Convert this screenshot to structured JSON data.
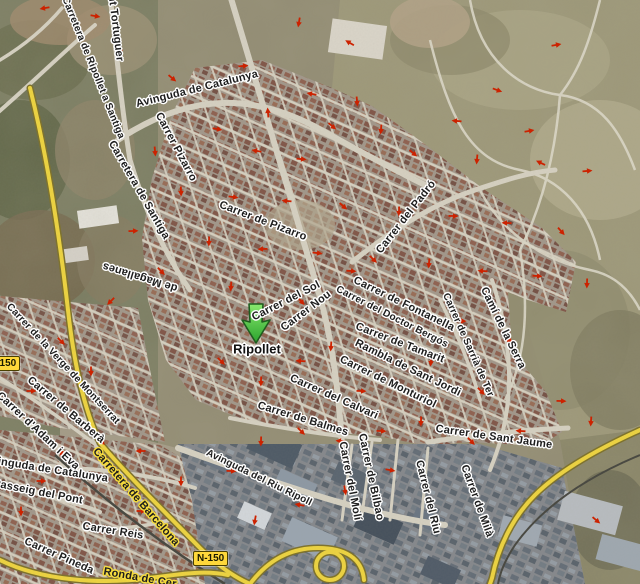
{
  "map": {
    "place_label": "Ripollet",
    "marker": {
      "type": "green-arrow",
      "tip_x": 256,
      "tip_y": 343
    },
    "colors": {
      "marker_green": "#3fc53f",
      "marker_outline": "#1f5c1f",
      "one_way_arrow": "#cc2200",
      "highway_yellow": "#eed43f",
      "label_halo_white": "#ffffff",
      "label_halo_yellow": "#f6dc3e",
      "badge_yellow": "#ffd83a"
    },
    "badges": [
      {
        "text": "N-150",
        "x": -15,
        "y": 356,
        "note": "left edge, partially clipped"
      },
      {
        "text": "N-150",
        "x": 193,
        "y": 551
      }
    ],
    "street_labels": [
      {
        "text": "Torrent Tortuguer",
        "x": 114,
        "y": 14,
        "rot": 83,
        "style": "white"
      },
      {
        "text": "Carretera de Ripollet a Santiga",
        "x": 93,
        "y": 68,
        "rot": 68,
        "style": "white"
      },
      {
        "text": "Avinguda de Catalunya",
        "x": 197,
        "y": 89,
        "rot": -14,
        "style": "white"
      },
      {
        "text": "Carrer Pizarro",
        "x": 176,
        "y": 147,
        "rot": 62,
        "style": "white"
      },
      {
        "text": "Carretera de Santiga",
        "x": 139,
        "y": 190,
        "rot": 60,
        "style": "white"
      },
      {
        "text": "de Magallanes",
        "x": 140,
        "y": 277,
        "rot": 197,
        "style": "white"
      },
      {
        "text": "Carrer de Pizarro",
        "x": 263,
        "y": 221,
        "rot": 21,
        "style": "white"
      },
      {
        "text": "Carrer del Padró",
        "x": 406,
        "y": 217,
        "rot": -52,
        "style": "white"
      },
      {
        "text": "Carrer del Sol",
        "x": 286,
        "y": 301,
        "rot": -27,
        "style": "white"
      },
      {
        "text": "Carrer Nou",
        "x": 306,
        "y": 311,
        "rot": -37,
        "style": "white"
      },
      {
        "text": "Carrer de Fontanella",
        "x": 404,
        "y": 304,
        "rot": 26,
        "style": "white"
      },
      {
        "text": "Carrer del Doctor Bergós",
        "x": 392,
        "y": 317,
        "rot": 27,
        "style": "white"
      },
      {
        "text": "Carrer de Tamarit",
        "x": 400,
        "y": 343,
        "rot": 21,
        "style": "white"
      },
      {
        "text": "Rambla de Sant Jordi",
        "x": 408,
        "y": 368,
        "rot": 26,
        "style": "white"
      },
      {
        "text": "Carrer de Monturiol",
        "x": 388,
        "y": 382,
        "rot": 26,
        "style": "white"
      },
      {
        "text": "Carrer del Calvari",
        "x": 334,
        "y": 397,
        "rot": 24,
        "style": "white"
      },
      {
        "text": "Carrer de Balmes",
        "x": 303,
        "y": 419,
        "rot": 17,
        "style": "white"
      },
      {
        "text": "Camí de la Serra",
        "x": 503,
        "y": 328,
        "rot": 64,
        "style": "white"
      },
      {
        "text": "Carrer de Sarrià de Ter",
        "x": 468,
        "y": 345,
        "rot": 66,
        "style": "white"
      },
      {
        "text": "Carrer de Sant Jaume",
        "x": 494,
        "y": 437,
        "rot": 8,
        "style": "white"
      },
      {
        "text": "Carrer de Milà",
        "x": 477,
        "y": 501,
        "rot": 70,
        "style": "white"
      },
      {
        "text": "Carrer del Riu",
        "x": 428,
        "y": 497,
        "rot": 76,
        "style": "white"
      },
      {
        "text": "Carrer de Bilbao",
        "x": 371,
        "y": 477,
        "rot": 78,
        "style": "white"
      },
      {
        "text": "Carrer del Molí",
        "x": 350,
        "y": 481,
        "rot": 79,
        "style": "white"
      },
      {
        "text": "Avinguda del Riu Ripoll",
        "x": 259,
        "y": 478,
        "rot": 26,
        "style": "white"
      },
      {
        "text": "Carrer de la Verge de Montserrat",
        "x": 63,
        "y": 364,
        "rot": 47,
        "style": "white"
      },
      {
        "text": "Carrer de Barberà",
        "x": 66,
        "y": 410,
        "rot": 40,
        "style": "white"
      },
      {
        "text": "Carrer d'Adam i Eva",
        "x": 38,
        "y": 431,
        "rot": 43,
        "style": "white"
      },
      {
        "text": "Avinguda de Catalunya",
        "x": 46,
        "y": 469,
        "rot": 9,
        "style": "white"
      },
      {
        "text": "Passeig del Pont",
        "x": 38,
        "y": 492,
        "rot": 11,
        "style": "white"
      },
      {
        "text": "Carretera de Barcelona",
        "x": 136,
        "y": 497,
        "rot": 49,
        "style": "yellow"
      },
      {
        "text": "Carrer Reis",
        "x": 113,
        "y": 531,
        "rot": 9,
        "style": "white"
      },
      {
        "text": "Carrer Pineda",
        "x": 59,
        "y": 556,
        "rot": 24,
        "style": "white"
      },
      {
        "text": "Ronda de Cer",
        "x": 140,
        "y": 578,
        "rot": 10,
        "style": "yellow"
      }
    ],
    "one_way_arrows": [
      [
        45,
        8,
        170
      ],
      [
        95,
        16,
        10
      ],
      [
        299,
        22,
        100
      ],
      [
        350,
        43,
        210
      ],
      [
        556,
        45,
        350
      ],
      [
        120,
        50,
        80
      ],
      [
        243,
        66,
        355
      ],
      [
        172,
        78,
        40
      ],
      [
        312,
        94,
        190
      ],
      [
        357,
        101,
        85
      ],
      [
        497,
        90,
        20
      ],
      [
        268,
        113,
        265
      ],
      [
        217,
        129,
        10
      ],
      [
        332,
        126,
        40
      ],
      [
        381,
        129,
        95
      ],
      [
        457,
        121,
        185
      ],
      [
        529,
        131,
        350
      ],
      [
        155,
        151,
        85
      ],
      [
        257,
        151,
        190
      ],
      [
        301,
        159,
        5
      ],
      [
        413,
        153,
        40
      ],
      [
        477,
        159,
        95
      ],
      [
        541,
        163,
        205
      ],
      [
        587,
        171,
        355
      ],
      [
        181,
        191,
        88
      ],
      [
        233,
        197,
        8
      ],
      [
        287,
        201,
        185
      ],
      [
        343,
        206,
        42
      ],
      [
        399,
        211,
        92
      ],
      [
        453,
        216,
        2
      ],
      [
        507,
        223,
        182
      ],
      [
        561,
        231,
        48
      ],
      [
        133,
        231,
        358
      ],
      [
        209,
        241,
        92
      ],
      [
        263,
        249,
        178
      ],
      [
        317,
        253,
        6
      ],
      [
        373,
        259,
        44
      ],
      [
        429,
        263,
        94
      ],
      [
        483,
        271,
        184
      ],
      [
        537,
        276,
        4
      ],
      [
        587,
        283,
        92
      ],
      [
        161,
        271,
        46
      ],
      [
        231,
        286,
        94
      ],
      [
        351,
        271,
        4
      ],
      [
        301,
        301,
        48
      ],
      [
        331,
        346,
        94
      ],
      [
        361,
        391,
        2
      ],
      [
        301,
        361,
        184
      ],
      [
        261,
        381,
        92
      ],
      [
        221,
        361,
        44
      ],
      [
        421,
        331,
        94
      ],
      [
        461,
        321,
        2
      ],
      [
        511,
        341,
        184
      ],
      [
        481,
        391,
        46
      ],
      [
        431,
        361,
        94
      ],
      [
        561,
        401,
        2
      ],
      [
        591,
        421,
        94
      ],
      [
        521,
        431,
        184
      ],
      [
        471,
        441,
        46
      ],
      [
        421,
        421,
        92
      ],
      [
        381,
        431,
        2
      ],
      [
        341,
        441,
        184
      ],
      [
        301,
        431,
        44
      ],
      [
        261,
        441,
        92
      ],
      [
        231,
        471,
        2
      ],
      [
        181,
        481,
        90
      ],
      [
        141,
        451,
        180
      ],
      [
        101,
        441,
        45
      ],
      [
        61,
        451,
        90
      ],
      [
        41,
        481,
        0
      ],
      [
        21,
        511,
        90
      ],
      [
        141,
        511,
        0
      ],
      [
        61,
        341,
        45
      ],
      [
        91,
        371,
        90
      ],
      [
        31,
        391,
        0
      ],
      [
        111,
        301,
        135
      ],
      [
        596,
        520,
        40
      ],
      [
        345,
        490,
        80
      ],
      [
        390,
        470,
        10
      ],
      [
        255,
        520,
        100
      ],
      [
        300,
        505,
        190
      ]
    ]
  }
}
